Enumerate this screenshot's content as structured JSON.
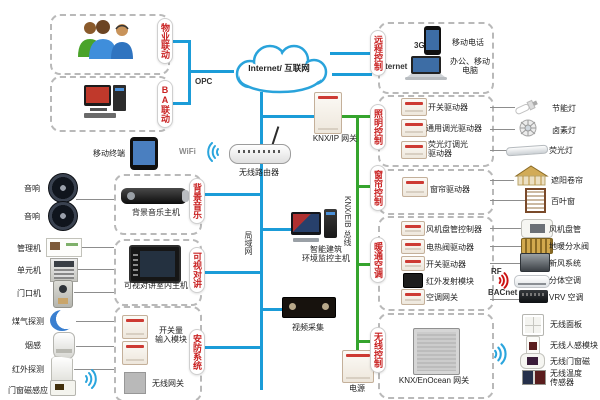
{
  "colors": {
    "line_blue": "#1b9cd8",
    "line_green": "#35a42d",
    "tab_red": "#c92222"
  },
  "cloud": {
    "label": "Internet/ 互联网"
  },
  "links": {
    "g3": "3G",
    "internet": "Internet",
    "opc": "OPC",
    "wifi": "WiFi",
    "rf": "RF",
    "bacnet": "BACnet",
    "lan": "局域网",
    "knx_bus": "KNX/EIB 总线"
  },
  "property": {
    "tab": "物业联动"
  },
  "ba": {
    "tab": "BA联动"
  },
  "remote": {
    "tab": "远程控制",
    "phone": "移动电话",
    "pc_l1": "办公、移动",
    "pc_l2": "电脑"
  },
  "lighting": {
    "tab": "照明控制",
    "m1": "开关驱动器",
    "m2": "通用调光驱动器",
    "m3_l1": "荧光灯调光",
    "m3_l2": "驱动器",
    "o1": "节能灯",
    "o2": "卤素灯",
    "o3": "荧光灯"
  },
  "curtain": {
    "tab": "窗帘控制",
    "m1": "窗帘驱动器",
    "o1": "遮阳卷帘",
    "o2": "百叶窗"
  },
  "hvac": {
    "tab": "暖通空调",
    "m1": "风机盘管控制器",
    "m2": "电热阀驱动器",
    "m3": "开关驱动器",
    "m4": "红外发射模块",
    "m5": "空调网关",
    "o1": "风机盘管",
    "o2": "地暖分水阀",
    "o3": "新风系统",
    "o4": "分体空调",
    "o5": "VRV 空调"
  },
  "wireless": {
    "tab": "无线控制",
    "gateway": "KNX/EnOcean 网关",
    "o1": "无线面板",
    "o2": "无线人感模块",
    "o3": "无线门窗磁",
    "o4_l1": "无线温度",
    "o4_l2": "传感器"
  },
  "center": {
    "router": "无线路由器",
    "knx_ip": "KNX/IP 网关",
    "host_l1": "智能建筑",
    "host_l2": "环境监控主机",
    "video": "视频采集",
    "power": "电源",
    "tablet": "移动终端"
  },
  "music": {
    "tab": "背景音乐",
    "host": "背景音乐主机",
    "in1": "音响",
    "in2": "音响"
  },
  "intercom": {
    "tab": "可视对讲",
    "host": "可视对讲室内主机",
    "in1": "管理机",
    "in2": "单元机",
    "in3": "门口机"
  },
  "security": {
    "tab": "安防系统",
    "m1_l1": "开关量",
    "m1_l2": "输入模块",
    "gw": "无线网关",
    "in1": "煤气探测",
    "in2": "烟感",
    "in3": "红外探测",
    "in4": "门窗磁感应"
  }
}
